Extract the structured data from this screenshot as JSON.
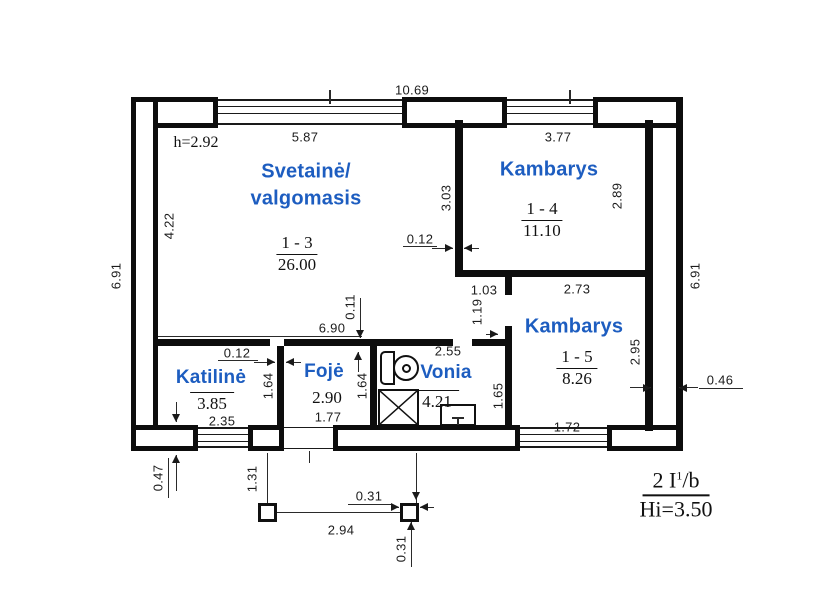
{
  "plan": {
    "height_note": "h=2.92",
    "title_block": {
      "numerator_main": "2 I",
      "numerator_sup": "1",
      "numerator_rest": "/b",
      "denominator": "Hi=3.50"
    },
    "rooms": {
      "svetaine": {
        "name_line1": "Svetainė/",
        "name_line2": "valgomasis",
        "number": "1 - 3",
        "area": "26.00"
      },
      "kambarys_1_4": {
        "name": "Kambarys",
        "number": "1 - 4",
        "area": "11.10"
      },
      "kambarys_1_5": {
        "name": "Kambarys",
        "number": "1 - 5",
        "area": "8.26"
      },
      "katiline": {
        "name": "Katilinė",
        "area": "3.85"
      },
      "foje": {
        "name": "Fojė",
        "area": "2.90"
      },
      "vonia": {
        "name": "Vonia",
        "area": "4.21"
      }
    },
    "dimensions": {
      "overall_top": "10.69",
      "svetaine_width": "5.87",
      "kambarys_1_4_width": "3.77",
      "left_height": "6.91",
      "right_height": "6.91",
      "svetaine_height": "4.22",
      "partition_1_4_length": "3.03",
      "partition_1_4_thickness": "0.12",
      "kambarys_1_4_height": "2.89",
      "opening_1_03": "1.03",
      "kambarys_1_5_width": "2.73",
      "door_1_19": "1.19",
      "inner_wall_length": "6.90",
      "inner_wall_thickness": "0.11",
      "vonia_width": "2.55",
      "katiline_wall_thickness": "0.12",
      "katiline_wall_length": "1.64",
      "foje_wall_length": "1.64",
      "vonia_height": "1.65",
      "kambarys_1_5_height": "2.95",
      "right_wall_thickness": "0.46",
      "katiline_width": "2.35",
      "foje_width": "1.77",
      "kambarys_1_5_window": "1.72",
      "porch_offset_left": "0.47",
      "porch_drop": "1.31",
      "porch_column_width": "0.31",
      "porch_span": "2.94",
      "porch_column_height": "0.31"
    }
  },
  "colors": {
    "wall": "#0d0d0d",
    "room_label": "#1d5dc0"
  }
}
